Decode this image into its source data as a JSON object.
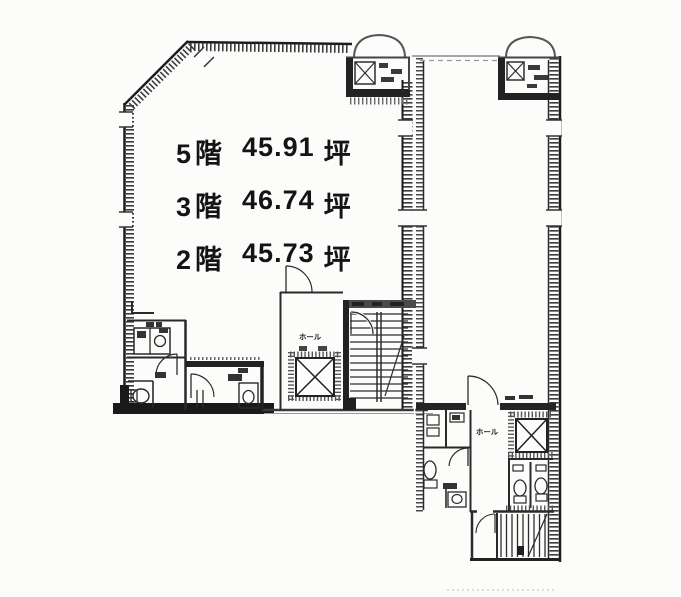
{
  "floor_areas": {
    "lines": [
      {
        "floor": "5階",
        "area": "45.91",
        "unit": "坪"
      },
      {
        "floor": "3階",
        "area": "46.74",
        "unit": "坪"
      },
      {
        "floor": "2階",
        "area": "45.73",
        "unit": "坪"
      }
    ]
  },
  "labels": {
    "hall_main": "ホール",
    "hall_annex": "ホール"
  },
  "colors": {
    "ink": "#1c1c1c",
    "wall": "#2e2e2e",
    "hatch": "#3d3d3d",
    "faint": "#9a9a9a",
    "paper": "#fcfcfb"
  }
}
